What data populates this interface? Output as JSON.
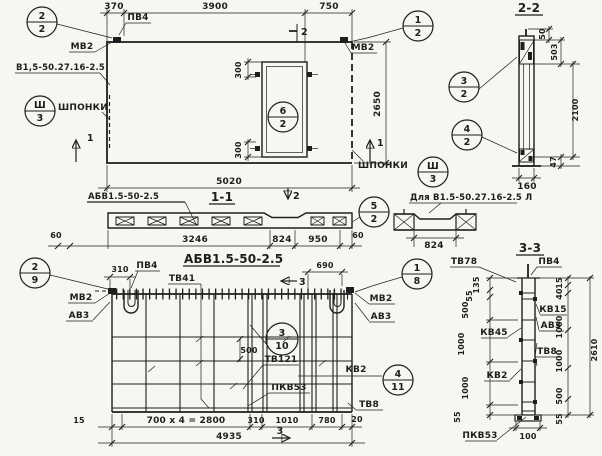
{
  "sheet": {
    "background": "#f7f6f1",
    "ink": "#1e1e1e"
  },
  "plan": {
    "callout_top_left": {
      "top": "2",
      "bottom": "2"
    },
    "callout_top_right": {
      "top": "1",
      "bottom": "2"
    },
    "callout_keys_left": {
      "top": "Ш",
      "bottom": "3"
    },
    "callout_keys_right": {
      "top": "Ш",
      "bottom": "3"
    },
    "callout_opening": {
      "top": "6",
      "bottom": "2"
    },
    "labels": {
      "pv4": "ПВ4",
      "mv2_left": "МВ2",
      "mv2_right": "МВ2",
      "panel_mark": "В1,5-50.27.16-2.5",
      "keys_left": "ШПОНКИ",
      "keys_right": "ШПОНКИ"
    },
    "dims": {
      "w370": "370",
      "w3900": "3900",
      "w750": "750",
      "w5020": "5020",
      "h2650": "2650",
      "o300_top": "300",
      "o300_bottom": "300"
    },
    "cuts": {
      "c1_left": "1",
      "c1_right": "1",
      "c2_top": "2",
      "c2_bottom": "2"
    }
  },
  "section22": {
    "title": "2-2",
    "callout_top": {
      "top": "3",
      "bottom": "2"
    },
    "callout_bottom": {
      "top": "4",
      "bottom": "2"
    },
    "dims": {
      "d50": "50",
      "d503": "503",
      "d2100": "2100",
      "d47": "47",
      "d160": "160"
    }
  },
  "section11": {
    "label": "АБВ1.5-50-2.5",
    "title": "1-1",
    "callout": {
      "top": "5",
      "bottom": "2"
    },
    "dims": {
      "left60": "60",
      "d3246": "3246",
      "d824": "824",
      "d950": "950",
      "right60": "60"
    },
    "variant": {
      "label": "Для В1.5-50.27.16-2.5 Л",
      "d824": "824"
    }
  },
  "elevation": {
    "title": "АБВ1.5-50-2.5",
    "callout_left": {
      "top": "2",
      "bottom": "9"
    },
    "callout_right": {
      "top": "1",
      "bottom": "8"
    },
    "callout_mid": {
      "top": "3",
      "bottom": "10"
    },
    "callout_kv2": {
      "top": "4",
      "bottom": "11"
    },
    "labels": {
      "pv4": "ПВ4",
      "tv41": "ТВ41",
      "mv2_left": "МВ2",
      "av3_left": "АВ3",
      "mv2_right": "МВ2",
      "av3_right": "АВ3",
      "tv121": "ТВ121",
      "pkv53": "ПКВ53",
      "kv2": "КВ2",
      "tv8": "ТВ8"
    },
    "dims": {
      "d310_top": "310",
      "d690": "690",
      "d500": "500",
      "d15": "15",
      "d700x4": "700 x 4 = 2800",
      "d310": "310",
      "d1010": "1010",
      "d780": "780",
      "d20": "20",
      "total": "4935"
    },
    "cuts": {
      "c3_top": "3",
      "c3_bottom": "3"
    }
  },
  "section33": {
    "title": "3-3",
    "labels": {
      "tv78": "ТВ78",
      "pv4": "ПВ4",
      "kv15": "КВ15",
      "av3": "АВ3",
      "tv8": "ТВ8",
      "kv45": "КВ45",
      "kv2": "КВ2",
      "pkv53": "ПКВ53"
    },
    "dims_left": [
      "135",
      "55",
      "500",
      "1000",
      "1000",
      "55"
    ],
    "dims_right": [
      "15",
      "40",
      "1000",
      "1000",
      "500",
      "55"
    ],
    "total": "2610",
    "base_width": "100"
  }
}
